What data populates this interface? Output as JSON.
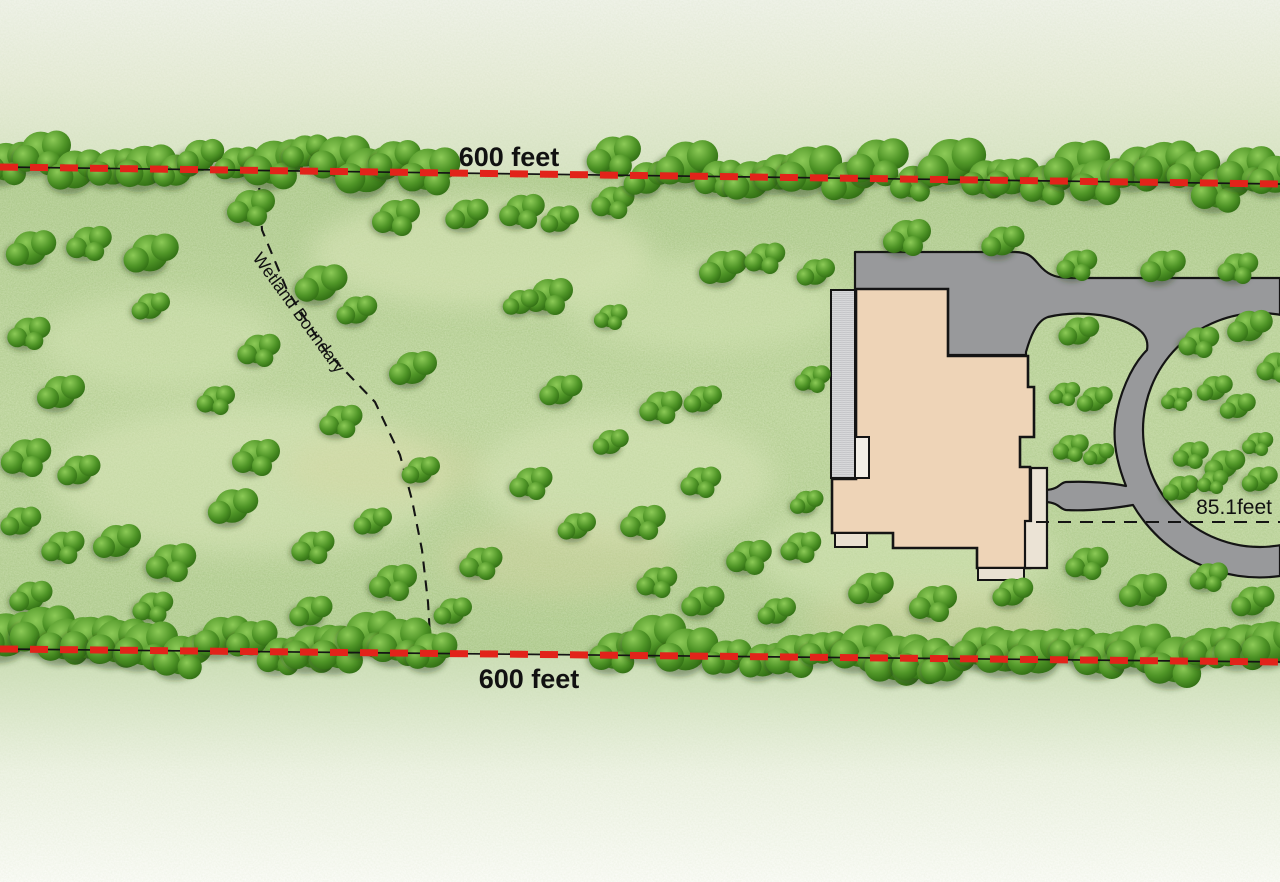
{
  "scene": {
    "width": 1280,
    "height": 882,
    "kind": "residential-site-plan"
  },
  "labels": {
    "top_boundary": "600 feet",
    "bottom_boundary": "600 feet",
    "wetland": "Wetland Boundary",
    "setback": "85.1feet"
  },
  "colors": {
    "boundary_red": "#e2231a",
    "line_black": "#141414",
    "field_green": "#c2d8a2",
    "field_green_deep": "#b5cf95",
    "mottle_light": "#dce8bc",
    "mottle_tan": "#d9d3a2",
    "outer_pale_top": "#eff2e8",
    "outer_pale_mid": "#d6e3c1",
    "outer_pale_bottom": "#fafbf6",
    "tree_light": "#8cca57",
    "tree_mid": "#4f9527",
    "tree_dark": "#2a660f",
    "tree_shadow": "rgba(35,62,18,0.40)",
    "driveway_gray": "#98999b",
    "house_fill": "#eed4b7",
    "porch_fill": "#ebe3d5",
    "step_fill": "#e9e1d2",
    "inset_fill": "#f2eee6",
    "deck_fill": "#d8d9db",
    "deck_line": "#bfc0c3"
  },
  "features": {
    "top_boundary_line": {
      "x1": 0,
      "y1": 167,
      "x2": 1280,
      "y2": 184,
      "label_x": 509,
      "label_y": 166
    },
    "bottom_boundary_line": {
      "x1": 0,
      "y1": 649,
      "x2": 1280,
      "y2": 662,
      "label_x": 529,
      "label_y": 688
    },
    "wetland_line": {
      "points": [
        [
          258,
          169
        ],
        [
          262,
          230
        ],
        [
          287,
          290
        ],
        [
          325,
          350
        ],
        [
          375,
          402
        ],
        [
          400,
          455
        ],
        [
          412,
          500
        ],
        [
          422,
          550
        ],
        [
          428,
          602
        ],
        [
          431,
          652
        ]
      ],
      "label_x": 252,
      "label_y": 258,
      "label_angle": 54
    },
    "setback_line": {
      "x1": 1036,
      "x2": 1280,
      "y": 522,
      "label_x": 1272,
      "label_y": 514
    }
  },
  "vegetation": {
    "row_top": {
      "spacing": 31,
      "jitter": 13,
      "skip_min": 433,
      "skip_max": 597
    },
    "row_bottom": {
      "spacing": 31,
      "jitter": 13,
      "skip_min": 462,
      "skip_max": 602
    },
    "field_clusters": [
      [
        30,
        248,
        1.05
      ],
      [
        88,
        242,
        0.95
      ],
      [
        150,
        253,
        1.15
      ],
      [
        250,
        206,
        1.0
      ],
      [
        320,
        283,
        1.1
      ],
      [
        395,
        216,
        1.0
      ],
      [
        466,
        214,
        0.9
      ],
      [
        521,
        210,
        0.95
      ],
      [
        559,
        219,
        0.8
      ],
      [
        612,
        201,
        0.9
      ],
      [
        722,
        267,
        1.0
      ],
      [
        764,
        257,
        0.85
      ],
      [
        815,
        272,
        0.8
      ],
      [
        28,
        332,
        0.9
      ],
      [
        150,
        306,
        0.8
      ],
      [
        258,
        349,
        0.9
      ],
      [
        356,
        310,
        0.85
      ],
      [
        548,
        295,
        1.0
      ],
      [
        520,
        302,
        0.75
      ],
      [
        610,
        316,
        0.7
      ],
      [
        60,
        392,
        1.0
      ],
      [
        215,
        399,
        0.8
      ],
      [
        412,
        368,
        1.0
      ],
      [
        340,
        420,
        0.9
      ],
      [
        560,
        390,
        0.9
      ],
      [
        660,
        406,
        0.9
      ],
      [
        702,
        399,
        0.8
      ],
      [
        25,
        456,
        1.05
      ],
      [
        78,
        470,
        0.9
      ],
      [
        255,
        456,
        1.0
      ],
      [
        420,
        470,
        0.8
      ],
      [
        530,
        482,
        0.9
      ],
      [
        610,
        442,
        0.75
      ],
      [
        700,
        481,
        0.85
      ],
      [
        20,
        521,
        0.85
      ],
      [
        62,
        546,
        0.9
      ],
      [
        116,
        541,
        1.0
      ],
      [
        170,
        561,
        1.05
      ],
      [
        232,
        506,
        1.05
      ],
      [
        312,
        546,
        0.9
      ],
      [
        372,
        521,
        0.8
      ],
      [
        480,
        562,
        0.9
      ],
      [
        576,
        526,
        0.8
      ],
      [
        642,
        521,
        0.95
      ],
      [
        30,
        596,
        0.9
      ],
      [
        152,
        606,
        0.85
      ],
      [
        310,
        611,
        0.9
      ],
      [
        392,
        581,
        1.0
      ],
      [
        452,
        611,
        0.8
      ],
      [
        656,
        581,
        0.85
      ],
      [
        702,
        601,
        0.9
      ],
      [
        748,
        556,
        0.95
      ],
      [
        776,
        611,
        0.8
      ],
      [
        800,
        546,
        0.85
      ],
      [
        870,
        588,
        0.95
      ],
      [
        932,
        602,
        1.0
      ],
      [
        1012,
        592,
        0.85
      ],
      [
        1086,
        562,
        0.9
      ],
      [
        1142,
        590,
        1.0
      ],
      [
        1208,
        576,
        0.8
      ],
      [
        1252,
        601,
        0.9
      ],
      [
        812,
        378,
        0.75
      ],
      [
        806,
        502,
        0.7
      ],
      [
        906,
        236,
        1.0
      ],
      [
        1002,
        241,
        0.9
      ],
      [
        1076,
        264,
        0.85
      ],
      [
        1162,
        266,
        0.95
      ],
      [
        1237,
        267,
        0.85
      ],
      [
        1078,
        331,
        0.85
      ],
      [
        1064,
        393,
        0.65
      ],
      [
        1094,
        399,
        0.75
      ],
      [
        1070,
        447,
        0.75
      ],
      [
        1098,
        454,
        0.65
      ],
      [
        1198,
        341,
        0.85
      ],
      [
        1249,
        326,
        0.95
      ],
      [
        1276,
        366,
        0.85
      ],
      [
        1214,
        388,
        0.75
      ],
      [
        1176,
        398,
        0.65
      ],
      [
        1237,
        406,
        0.75
      ],
      [
        1190,
        454,
        0.75
      ],
      [
        1224,
        464,
        0.85
      ],
      [
        1257,
        443,
        0.65
      ],
      [
        1180,
        488,
        0.75
      ],
      [
        1212,
        481,
        0.65
      ],
      [
        1259,
        479,
        0.75
      ]
    ]
  }
}
